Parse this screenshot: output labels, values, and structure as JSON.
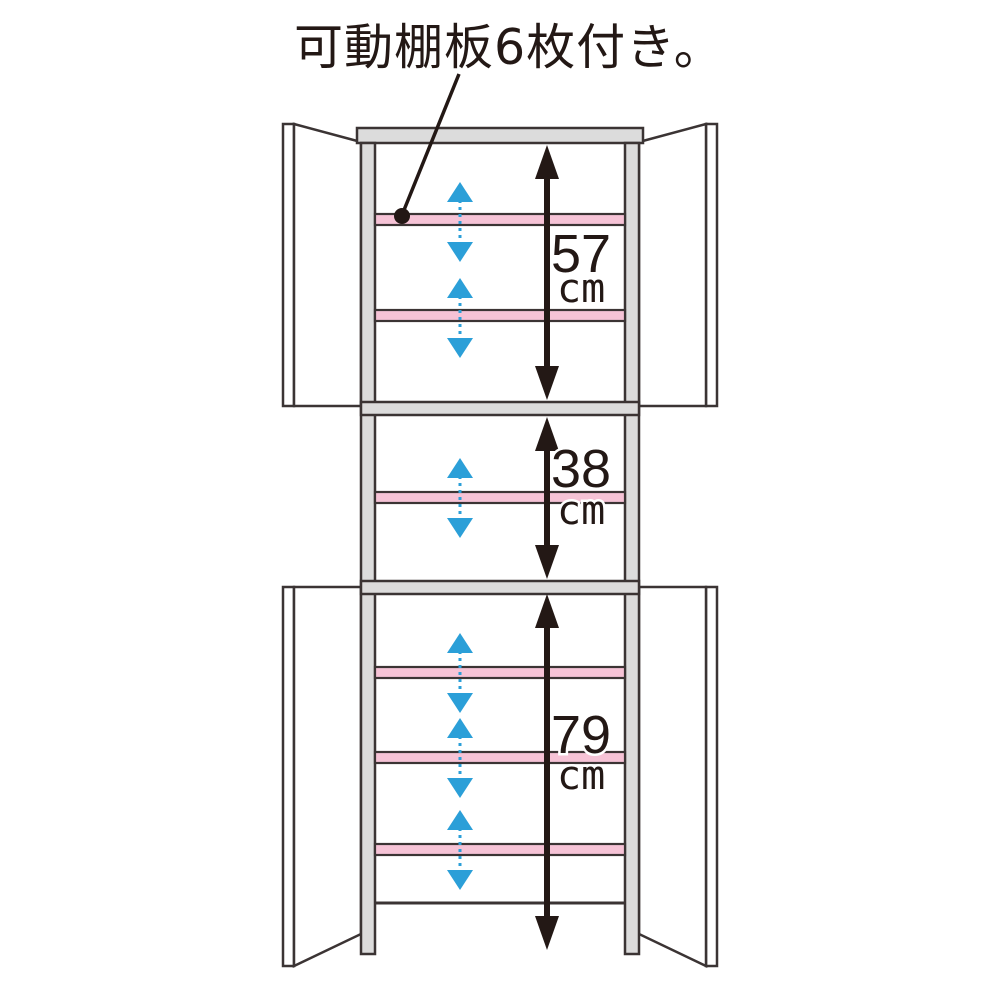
{
  "title": {
    "text": "可動棚板6枚付き。"
  },
  "dimensions": {
    "top": {
      "value": "57",
      "unit": "cm"
    },
    "middle": {
      "value": "38",
      "unit": "cm"
    },
    "bottom": {
      "value": "79",
      "unit": "cm"
    }
  },
  "shelves": {
    "movable_count": 6,
    "fixed_count": 2
  },
  "colors": {
    "shelf_pink": "#f6c3d6",
    "frame_gray": "#dcdcdc",
    "arrow_blue": "#2b9fd8",
    "ink_black": "#231815",
    "outline": "#3b3434"
  }
}
